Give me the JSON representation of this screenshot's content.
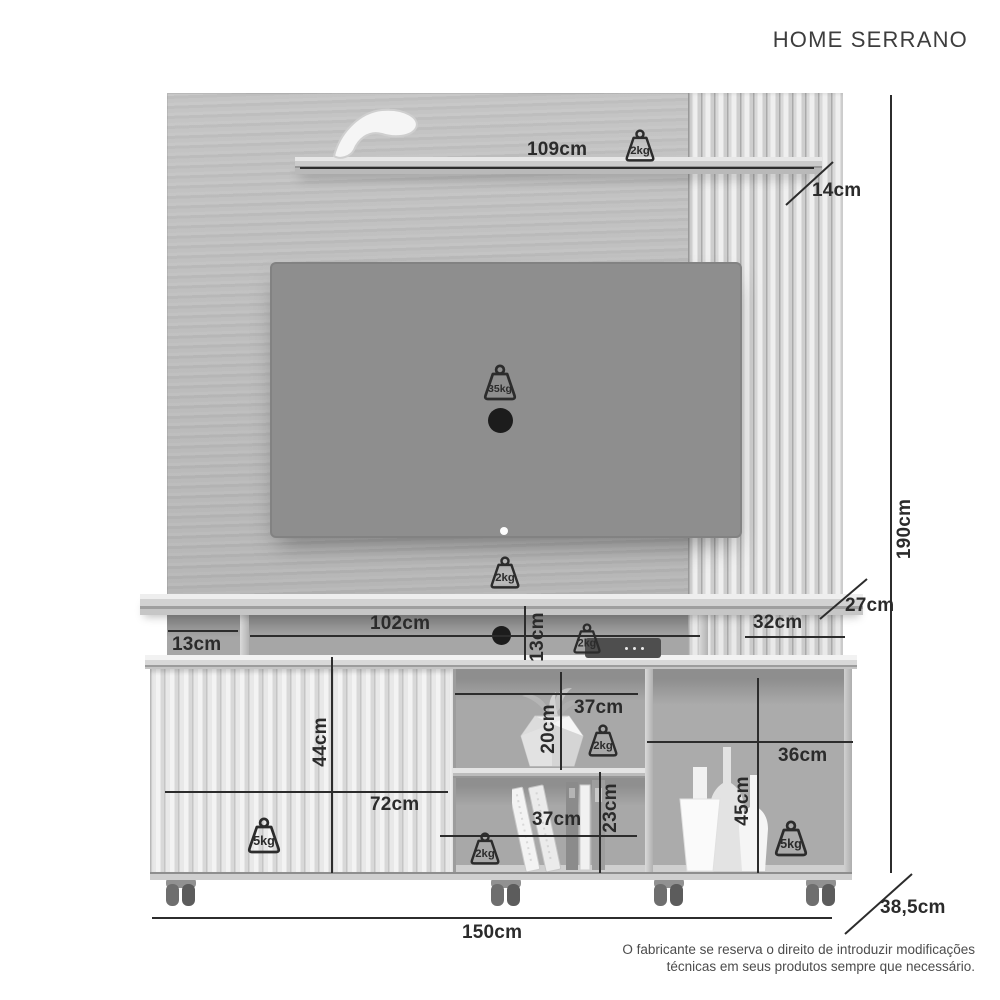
{
  "title": "HOME SERRANO",
  "footer": {
    "line1": "O fabricante se reserva o direito de introduzir modificações",
    "line2": "técnicas em seus produtos sempre que necessário."
  },
  "colors": {
    "dimension_line": "#2c2c2c",
    "dimension_label": "#2b2b2b",
    "tv_screen": "#8e8e8e",
    "panel_wood": "#bcbcbc",
    "title_text": "#3d3d3d",
    "footer_text": "#4c4c4c",
    "hole_black": "#1c1c1c"
  },
  "dimensions": {
    "horizontal": [
      {
        "id": "top-shelf-width",
        "label": "109cm",
        "x": 300,
        "y": 167,
        "len": 514,
        "label_x": 527,
        "label_y": 139
      },
      {
        "id": "console-width",
        "label": "102cm",
        "x": 250,
        "y": 635,
        "len": 450,
        "label_x": 370,
        "label_y": 613
      },
      {
        "id": "console-left-width",
        "label": "13cm",
        "x": 168,
        "y": 630,
        "len": 70,
        "label_x": 172,
        "label_y": 634
      },
      {
        "id": "console-right-width",
        "label": "32cm",
        "x": 745,
        "y": 636,
        "len": 100,
        "label_x": 753,
        "label_y": 612
      },
      {
        "id": "door-width",
        "label": "72cm",
        "x": 165,
        "y": 791,
        "len": 283,
        "label_x": 370,
        "label_y": 794
      },
      {
        "id": "middle-top-niche-width",
        "label": "37cm",
        "x": 455,
        "y": 693,
        "len": 183,
        "label_x": 574,
        "label_y": 697
      },
      {
        "id": "middle-bottom-niche-width",
        "label": "37cm",
        "x": 440,
        "y": 835,
        "len": 197,
        "label_x": 532,
        "label_y": 809
      },
      {
        "id": "right-niche-width",
        "label": "36cm",
        "x": 647,
        "y": 741,
        "len": 206,
        "label_x": 778,
        "label_y": 745
      },
      {
        "id": "total-width",
        "label": "150cm",
        "x": 152,
        "y": 917,
        "len": 680,
        "label_x": 462,
        "label_y": 922
      }
    ],
    "vertical": [
      {
        "id": "total-height",
        "label": "190cm",
        "x": 890,
        "y": 95,
        "len": 778,
        "label_cx": 905,
        "label_cy": 529
      },
      {
        "id": "console-niche-height",
        "label": "13cm",
        "x": 524,
        "y": 606,
        "len": 54,
        "label_cx": 538,
        "label_cy": 637
      },
      {
        "id": "door-height",
        "label": "44cm",
        "x": 331,
        "y": 657,
        "len": 216,
        "label_cx": 321,
        "label_cy": 742
      },
      {
        "id": "middle-top-niche-height",
        "label": "20cm",
        "x": 560,
        "y": 672,
        "len": 98,
        "label_cx": 549,
        "label_cy": 729
      },
      {
        "id": "middle-bottom-niche-height",
        "label": "23cm",
        "x": 599,
        "y": 772,
        "len": 101,
        "label_cx": 611,
        "label_cy": 808
      },
      {
        "id": "right-niche-height",
        "label": "45cm",
        "x": 757,
        "y": 678,
        "len": 195,
        "label_cx": 743,
        "label_cy": 801
      }
    ],
    "diagonal": [
      {
        "id": "shelf-depth",
        "label": "14cm",
        "x1": 786,
        "y1": 205,
        "x2": 833,
        "y2": 162,
        "label_x": 812,
        "label_y": 180
      },
      {
        "id": "console-depth",
        "label": "27cm",
        "x1": 820,
        "y1": 619,
        "x2": 867,
        "y2": 579,
        "label_x": 845,
        "label_y": 595
      },
      {
        "id": "total-depth",
        "label": "38,5cm",
        "x1": 845,
        "y1": 934,
        "x2": 912,
        "y2": 874,
        "label_x": 880,
        "label_y": 897
      }
    ]
  },
  "weights": [
    {
      "id": "top-shelf-capacity",
      "label": "2kg",
      "x": 621,
      "y": 129,
      "size": 38
    },
    {
      "id": "tv-panel-capacity",
      "label": "35kg",
      "x": 479,
      "y": 364,
      "size": 42
    },
    {
      "id": "console-shelf-capacity",
      "label": "2kg",
      "x": 486,
      "y": 556,
      "size": 38
    },
    {
      "id": "console-niche-capacity",
      "label": "2kg",
      "x": 569,
      "y": 623,
      "size": 36
    },
    {
      "id": "middle-top-niche-capacity",
      "label": "2kg",
      "x": 584,
      "y": 724,
      "size": 38
    },
    {
      "id": "middle-bottom-niche-capacity",
      "label": "2kg",
      "x": 466,
      "y": 832,
      "size": 38
    },
    {
      "id": "door-shelf-capacity",
      "label": "5kg",
      "x": 243,
      "y": 817,
      "size": 42
    },
    {
      "id": "right-niche-capacity",
      "label": "5kg",
      "x": 770,
      "y": 820,
      "size": 42
    }
  ]
}
